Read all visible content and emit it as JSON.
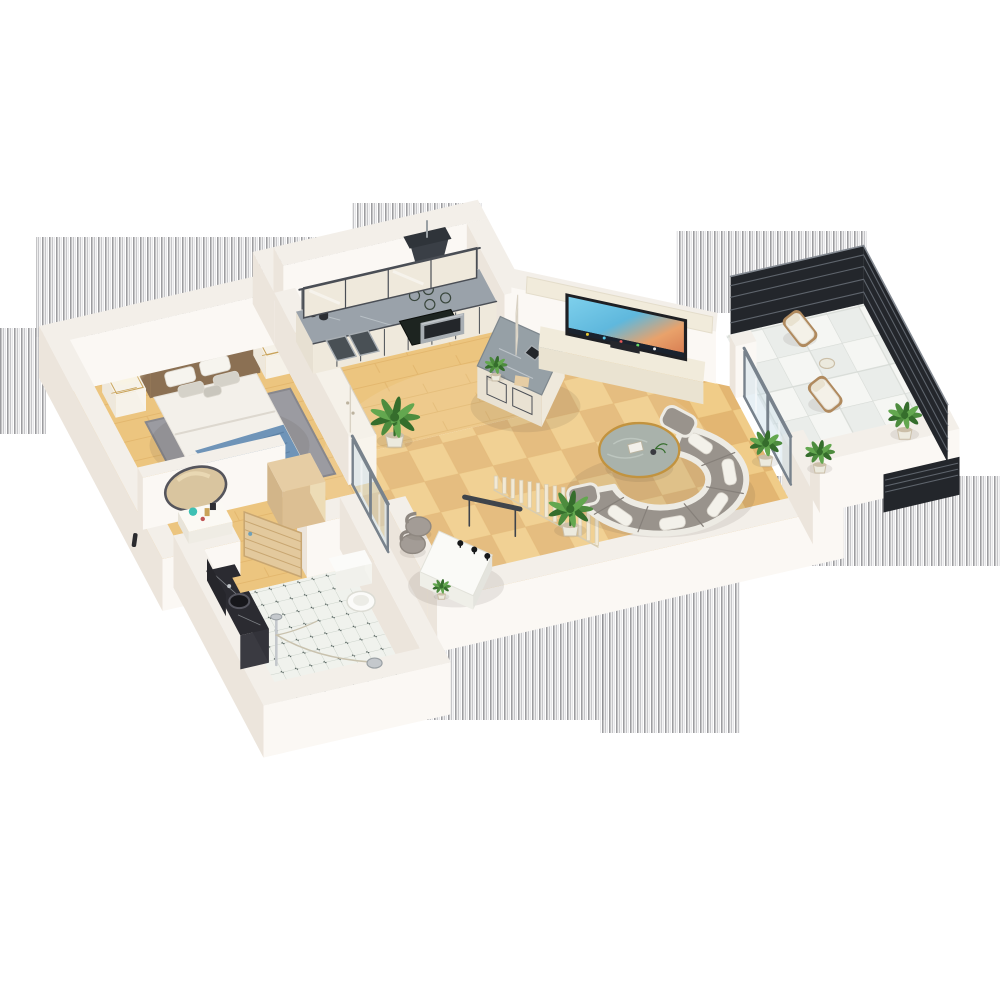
{
  "meta": {
    "label": "3D isometric apartment floor plan render",
    "type": "3d-floorplan-render"
  },
  "scene": {
    "rooms": [
      {
        "name": "bedroom",
        "floor": "wood",
        "furniture": [
          "double-bed",
          "nightstand-left",
          "nightstand-right",
          "table-lamp",
          "rug",
          "flower-vase"
        ]
      },
      {
        "name": "hallway-dressing",
        "floor": "wood",
        "furniture": [
          "oval-vanity-mirror",
          "vanity-shelf",
          "cosmetics",
          "wood-cabinet",
          "wardrobe",
          "sliding-glass-door"
        ]
      },
      {
        "name": "bathroom",
        "floor": "dot-tile",
        "furniture": [
          "black-marble-vanity",
          "round-sink",
          "shower-set",
          "toilet",
          "wooden-door-open"
        ]
      },
      {
        "name": "kitchen",
        "floor": "wood",
        "furniture": [
          "counter-run",
          "double-sink",
          "cooktop",
          "oven",
          "range-hood",
          "upper-cabinets",
          "marble-island",
          "island-sink",
          "island-plant"
        ]
      },
      {
        "name": "living-room",
        "floor": "parquet",
        "furniture": [
          "tv-wall-unit",
          "tv",
          "media-console",
          "soundbar",
          "curved-sofa",
          "round-marble-coffee-table",
          "desk",
          "desk-chairs",
          "slat-stair-screen",
          "potted-plants"
        ]
      },
      {
        "name": "balcony",
        "floor": "white-tile",
        "furniture": [
          "lounge-chair-1",
          "lounge-chair-2",
          "side-table",
          "balcony-plants",
          "dark-slat-railing",
          "white-parapet"
        ]
      }
    ],
    "artifacts": {
      "stripe_bands": 7,
      "description": "vertical gray stripe matte bands around exterior walls"
    }
  },
  "palette": {
    "bg": "#ffffff",
    "stripe_dark": "#8e8e92",
    "stripe_mid": "#b6b6ba",
    "stripe_light": "#d6d6d9",
    "wall_top": "#f3efe9",
    "wall_south": "#fbf8f4",
    "wall_west": "#ece5dc",
    "wall_edge": "#e2dbd0",
    "wood": "#ecc57f",
    "wood_line": "#dcab61",
    "parquet_a": "#f0cc88",
    "parquet_b": "#e3b672",
    "tile_bg": "#f0f2ed",
    "tile_line": "#ccd3cb",
    "tile_dot": "#44524f",
    "btile_bg": "#eaedea",
    "btile_line": "#d7dbd6",
    "btile_alt": "#f5f6f3",
    "rug": "#9b9ba1",
    "rug_border": "#87878d",
    "bed_frame": "#8b7053",
    "bed_frame_top": "#7a6248",
    "mattress": "#f3f0ea",
    "duvet_line": "#ddd8cf",
    "pillow_white": "#f6f4ee",
    "pillow_gray": "#d5d2c9",
    "pillow_accent": "#c9c6bd",
    "blanket": "#6f94b8",
    "blanket_fold": "#5d82a6",
    "blanket_drop": "#648bad",
    "stand": "#f6f2e9",
    "gold": "#c9a35a",
    "lamp_glow": "#fff6d8",
    "flower_pink": "#e39ab2",
    "flower_pink2": "#d989a3",
    "wardrobe": "#f6f2ea",
    "seam": "#d9d2c4",
    "cabinet_wood": "#e6cda4",
    "door_wood": "#e3c99d",
    "door_wood_edge": "#c8a671",
    "mirror_face": "#d9c59f",
    "mirror_hi": "#ecdcb8",
    "mirror_rim": "#55555c",
    "teal": "#3ec0b4",
    "red_small": "#c05555",
    "vanity_black": "#2b2b31",
    "vanity_black_face": "#3a3a41",
    "vanity_dark2": "#26262b",
    "chrome": "#c4c8cc",
    "chrome_dark": "#9aa0a4",
    "porcelain": "#fbfbf9",
    "porcelain_edge": "#dcdcd4",
    "counter_marble": "#9aa2aa",
    "marble_vein": "#cdd3d8",
    "cab_frame": "#4a4e55",
    "cab_panel": "#efe9dc",
    "cooktop": "#1d2420",
    "cooktop_ring": "#39463c",
    "steel": "#a8aeb3",
    "steel_dark": "#23262a",
    "hood": "#3a3f46",
    "hood_top": "#2f343a",
    "island_marble": "#96a0a6",
    "tv_frame": "#1e1f23",
    "tv_band": "#1a222e",
    "console": "#f1ebdb",
    "console_face": "#eae3d1",
    "sofa_gray": "#99938c",
    "sofa_light": "#edebe4",
    "sofa_pillow": "#f3f1ea",
    "sofa_dark": "#86807a",
    "table_marble": "#a9b2ab",
    "table_gold": "#c2933f",
    "desk_white": "#fafaf7",
    "desk_edge": "#e4e4de",
    "mic_black": "#17181a",
    "bar_dark": "#3f444b",
    "chair_gray": "#a39c96",
    "chair_line": "#8f8881",
    "slat": "#f2e9d5",
    "slat_edge": "#d8ccb0",
    "glass": "rgba(198,219,231,0.42)",
    "glass_hi": "rgba(255,255,255,0.45)",
    "frame_gray": "#78828c",
    "rail_dark": "#23262b",
    "rail_gap": "#5e646c",
    "rail_hi": "#858b93",
    "leaf_a": "#4d8c3e",
    "leaf_b": "#356d2c",
    "leaf_c": "#63a74f",
    "pot_white": "#eceade",
    "pot_rim": "#cbbfa8",
    "lounger_wood": "#b08a5e",
    "cushion": "#f4f1e8",
    "cushion_edge": "#e3ded2",
    "shadow": "rgba(70,58,45,0.10)",
    "tv_dot1": "#e8c832",
    "tv_dot2": "#58c8e8",
    "tv_dot3": "#e85858",
    "tv_dot4": "#68d868",
    "tv_dot5": "#e8e8e8",
    "handle_dark": "#2a2a2e",
    "hose": "#c9c2ae"
  }
}
